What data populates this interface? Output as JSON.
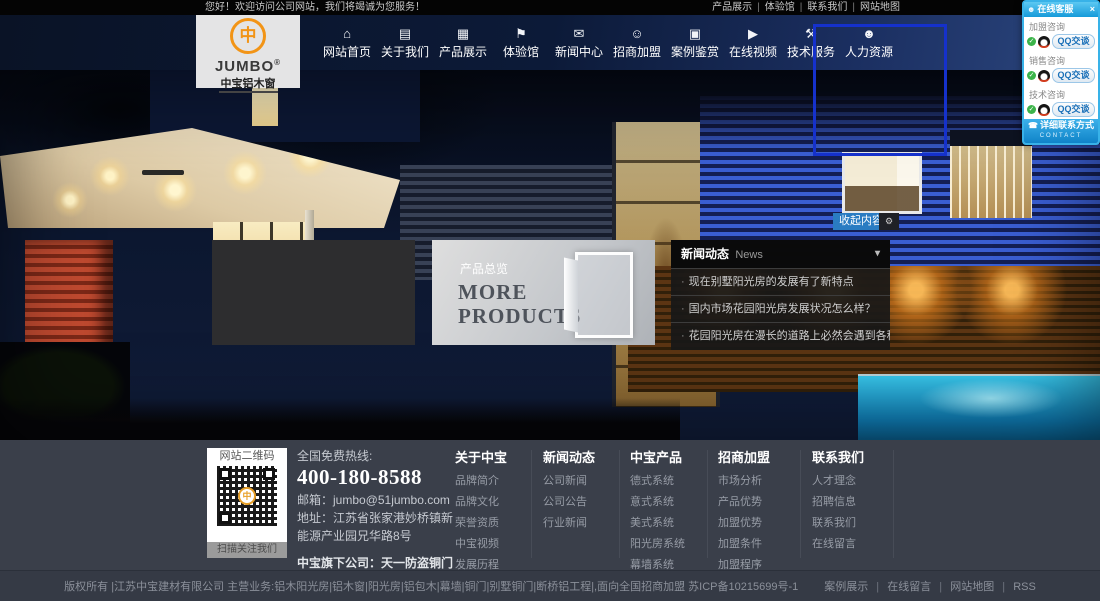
{
  "accents": {
    "nav_bg": "#0c1a38",
    "button_blue": "#2a7cc2",
    "qq_border_blue": "#38b2e8",
    "emblem_orange": "#f29416",
    "footer_bg": "#3a3f4a",
    "selection_outline_blue": "#1531cc"
  },
  "topbar": {
    "greeting": "您好！欢迎访问公司网站，我们将竭诚为您服务！",
    "sep": "|",
    "links": [
      "产品展示",
      "体验馆",
      "联系我们",
      "网站地图"
    ]
  },
  "logo": {
    "emblem_glyph": "中",
    "brand": "JUMBO",
    "reg": "®",
    "subtitle": "中宝铝木窗"
  },
  "nav": {
    "items": [
      {
        "label": "网站首页",
        "icon": "home-icon",
        "glyph": "⌂"
      },
      {
        "label": "关于我们",
        "icon": "book-icon",
        "glyph": "▤"
      },
      {
        "label": "产品展示",
        "icon": "grid-icon",
        "glyph": "▦"
      },
      {
        "label": "体验馆",
        "icon": "shield-icon",
        "glyph": "⚑"
      },
      {
        "label": "新闻中心",
        "icon": "chat-icon",
        "glyph": "✉"
      },
      {
        "label": "招商加盟",
        "icon": "member-add-icon",
        "glyph": "☺"
      },
      {
        "label": "案例鉴赏",
        "icon": "photo-icon",
        "glyph": "▣"
      },
      {
        "label": "在线视频",
        "icon": "video-play-icon",
        "glyph": "▶"
      },
      {
        "label": "技术服务",
        "icon": "tools-icon",
        "glyph": "⚒"
      },
      {
        "label": "人力资源",
        "icon": "person-icon",
        "glyph": "☻"
      }
    ]
  },
  "hero": {
    "collapse_label": "收起内容",
    "collapse_extra_glyph": "⚙",
    "product_panel": {
      "label": "产品总览",
      "heading": "MORE PRODUCTS"
    },
    "news_panel": {
      "title": "新闻动态",
      "subtitle": "News",
      "caret": "▾",
      "bullet": "·",
      "items": [
        "现在别墅阳光房的发展有了新特点",
        "国内市场花园阳光房发展状况怎么样？",
        "花园阳光房在漫长的道路上必然会遇到各种挑战"
      ]
    }
  },
  "service_panel": {
    "title": "在线客服",
    "header_icon_glyph": "☻",
    "close_glyph": "×",
    "check_glyph": "✓",
    "button_label": "QQ交谈",
    "groups": [
      {
        "label": "加盟咨询"
      },
      {
        "label": "销售咨询"
      },
      {
        "label": "技术咨询"
      }
    ],
    "footer_label": "详细联系方式",
    "footer_icon_glyph": "☎",
    "footer_sub": "CONTACT"
  },
  "footer": {
    "qr": {
      "title": "网站二维码",
      "emblem_glyph": "中",
      "caption": "扫描关注我们"
    },
    "contact": {
      "hotline_label": "全国免费热线:",
      "phone": "400-180-8588",
      "email": "邮箱：jumbo@51jumbo.com",
      "address": "地址：江苏省张家港妙桥镇新能源产业园兄华路8号",
      "subsidiary": "中宝旗下公司：天一防盗铜门"
    },
    "columns": [
      {
        "title": "关于中宝",
        "links": [
          "品牌简介",
          "品牌文化",
          "荣誉资质",
          "中宝视频",
          "发展历程",
          "品牌形象"
        ]
      },
      {
        "title": "新闻动态",
        "links": [
          "公司新闻",
          "公司公告",
          "行业新闻"
        ]
      },
      {
        "title": "中宝产品",
        "links": [
          "德式系统",
          "意式系统",
          "美式系统",
          "阳光房系统",
          "幕墙系统",
          "断桥铝系统"
        ]
      },
      {
        "title": "招商加盟",
        "links": [
          "市场分析",
          "产品优势",
          "加盟优势",
          "加盟条件",
          "加盟程序",
          "加盟留言",
          "申请表下载"
        ]
      },
      {
        "title": "联系我们",
        "links": [
          "人才理念",
          "招聘信息",
          "联系我们",
          "在线留言"
        ]
      }
    ]
  },
  "bottombar": {
    "copyright": "版权所有 |江苏中宝建材有限公司 主营业务:铝木阳光房|铝木窗|阳光房|铝包木|幕墙|铜门|别墅铜门|断桥铝工程|,面向全国招商加盟 苏ICP备10215699号-1",
    "sep": "|",
    "links": [
      "案例展示",
      "在线留言",
      "网站地图",
      "RSS"
    ]
  }
}
